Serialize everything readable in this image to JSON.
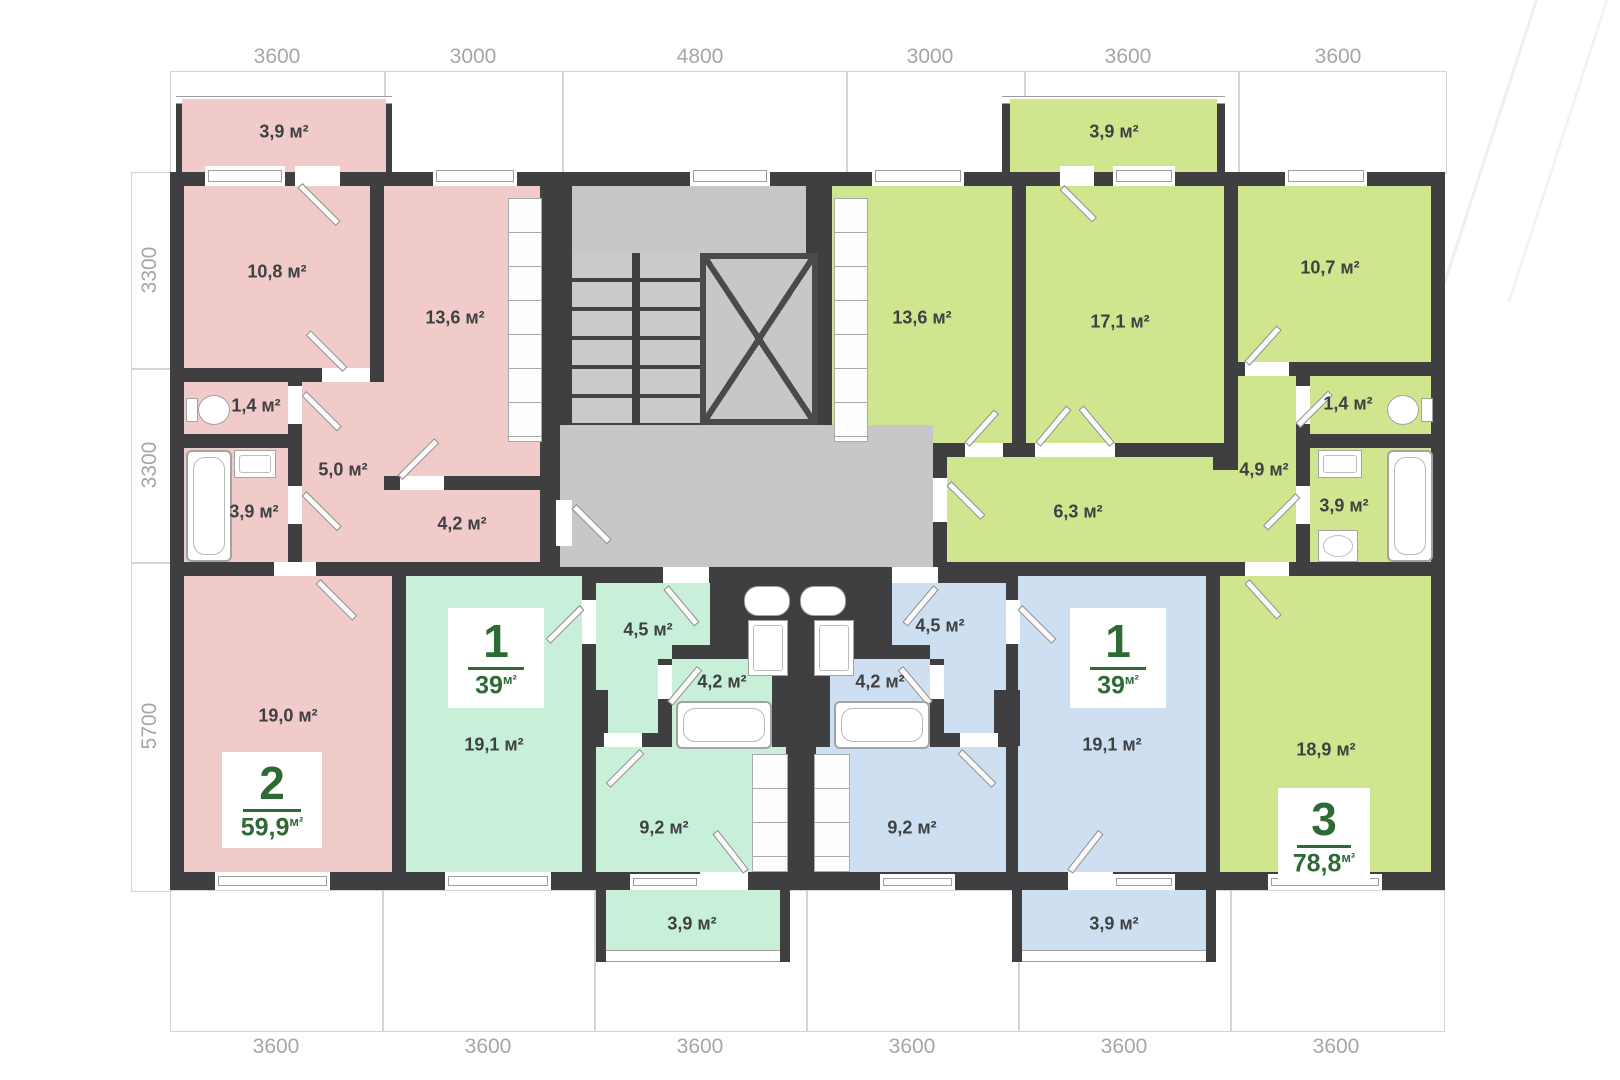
{
  "colors": {
    "wall": "#3f3f41",
    "pink": "#f1caca",
    "mint": "#c8efd8",
    "blue": "#cfdff2",
    "lime": "#cfe68f",
    "gray": "#c7c7c7",
    "brand": "#2e6b34",
    "label": "#3e4042",
    "dim": "#a6a6a6",
    "fixture": "#9e9e9e"
  },
  "dimensions": {
    "top": [
      "3600",
      "3000",
      "4800",
      "3000",
      "3600",
      "3600"
    ],
    "left": [
      "3300",
      "3300",
      "5700"
    ],
    "bottom": [
      "3600",
      "3600",
      "3600",
      "3600",
      "3600",
      "3600"
    ]
  },
  "rooms": {
    "pink_balcony": "3,9 м²",
    "pink_bedroom": "10,8 м²",
    "pink_kitchen": "13,6 м²",
    "pink_wc": "1,4 м²",
    "pink_hall": "5,0 м²",
    "pink_bath": "3,9 м²",
    "pink_corridor": "4,2 м²",
    "pink_living": "19,0 м²",
    "mint_living": "19,1 м²",
    "mint_hall": "4,5 м²",
    "mint_bath": "4,2 м²",
    "mint_kitchen": "9,2 м²",
    "mint_balcony": "3,9 м²",
    "blue_hall": "4,5 м²",
    "blue_bath": "4,2 м²",
    "blue_kitchen": "9,2 м²",
    "blue_living": "19,1 м²",
    "blue_balcony": "3,9 м²",
    "green_balcony": "3,9 м²",
    "green_kitchen": "13,6 м²",
    "green_room_171": "17,1 м²",
    "green_room_107": "10,7 м²",
    "green_wc": "1,4 м²",
    "green_hall_49": "4,9 м²",
    "green_bath": "3,9 м²",
    "green_hall_63": "6,3 м²",
    "green_living": "18,9 м²"
  },
  "apartments": {
    "apt2": {
      "number": "2",
      "area": "59,9",
      "unit": "м²"
    },
    "apt1_left": {
      "number": "1",
      "area": "39",
      "unit": "м²"
    },
    "apt1_right": {
      "number": "1",
      "area": "39",
      "unit": "м²"
    },
    "apt3": {
      "number": "3",
      "area": "78,8",
      "unit": "м²"
    }
  }
}
